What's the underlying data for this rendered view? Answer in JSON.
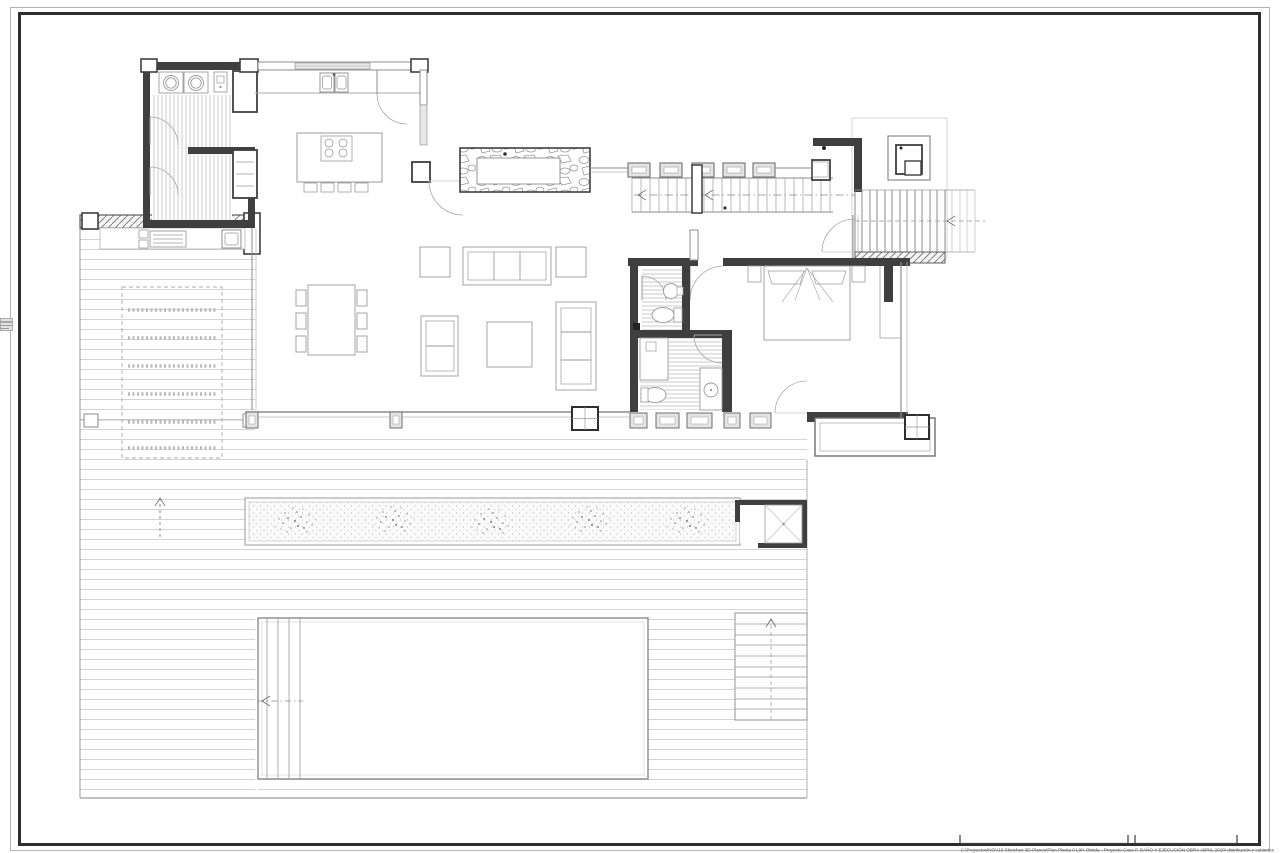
{
  "sheet": {
    "background_color": "#ffffff",
    "border_outer_color": "#b3b3b3",
    "border_inner_color": "#2e2e2e",
    "footer_file_path": "C:\\Proyectos\\NOV19 Sketches 3D-Planos\\Plan Planta 0 L9H Obrida - Proyecto Casa P. BAÑO Y EJECUCIÓN OBRA ABRIL 2020\\ distribución y cubiertas",
    "scale_bar_count": 2,
    "left_edge_marker": "reference-tab"
  },
  "palette": {
    "wall_dark": "#3f3f3f",
    "wall_grey": "#8c8c8c",
    "line_light": "#d2d2d2",
    "line_mid": "#a0a0a0",
    "furniture_line": "#9b9b9b",
    "hatch_line": "#8f8f8f",
    "dash_line": "#888888"
  },
  "plan": {
    "type": "architectural-floor-plan",
    "view": "ground-floor-with-pool-and-deck",
    "features": [
      "laundry-room",
      "kitchen",
      "kitchen-island",
      "fireplace",
      "living-room",
      "dining-table",
      "sofa-set",
      "interior-staircase",
      "entry-staircase",
      "bbq-unit",
      "bedroom",
      "bathroom-upper",
      "bathroom-lower",
      "terrace",
      "wood-deck",
      "pergola-dashed",
      "planter-strip",
      "outdoor-shower",
      "swimming-pool",
      "pool-steps",
      "pool-staircase",
      "outdoor-kitchen"
    ]
  }
}
